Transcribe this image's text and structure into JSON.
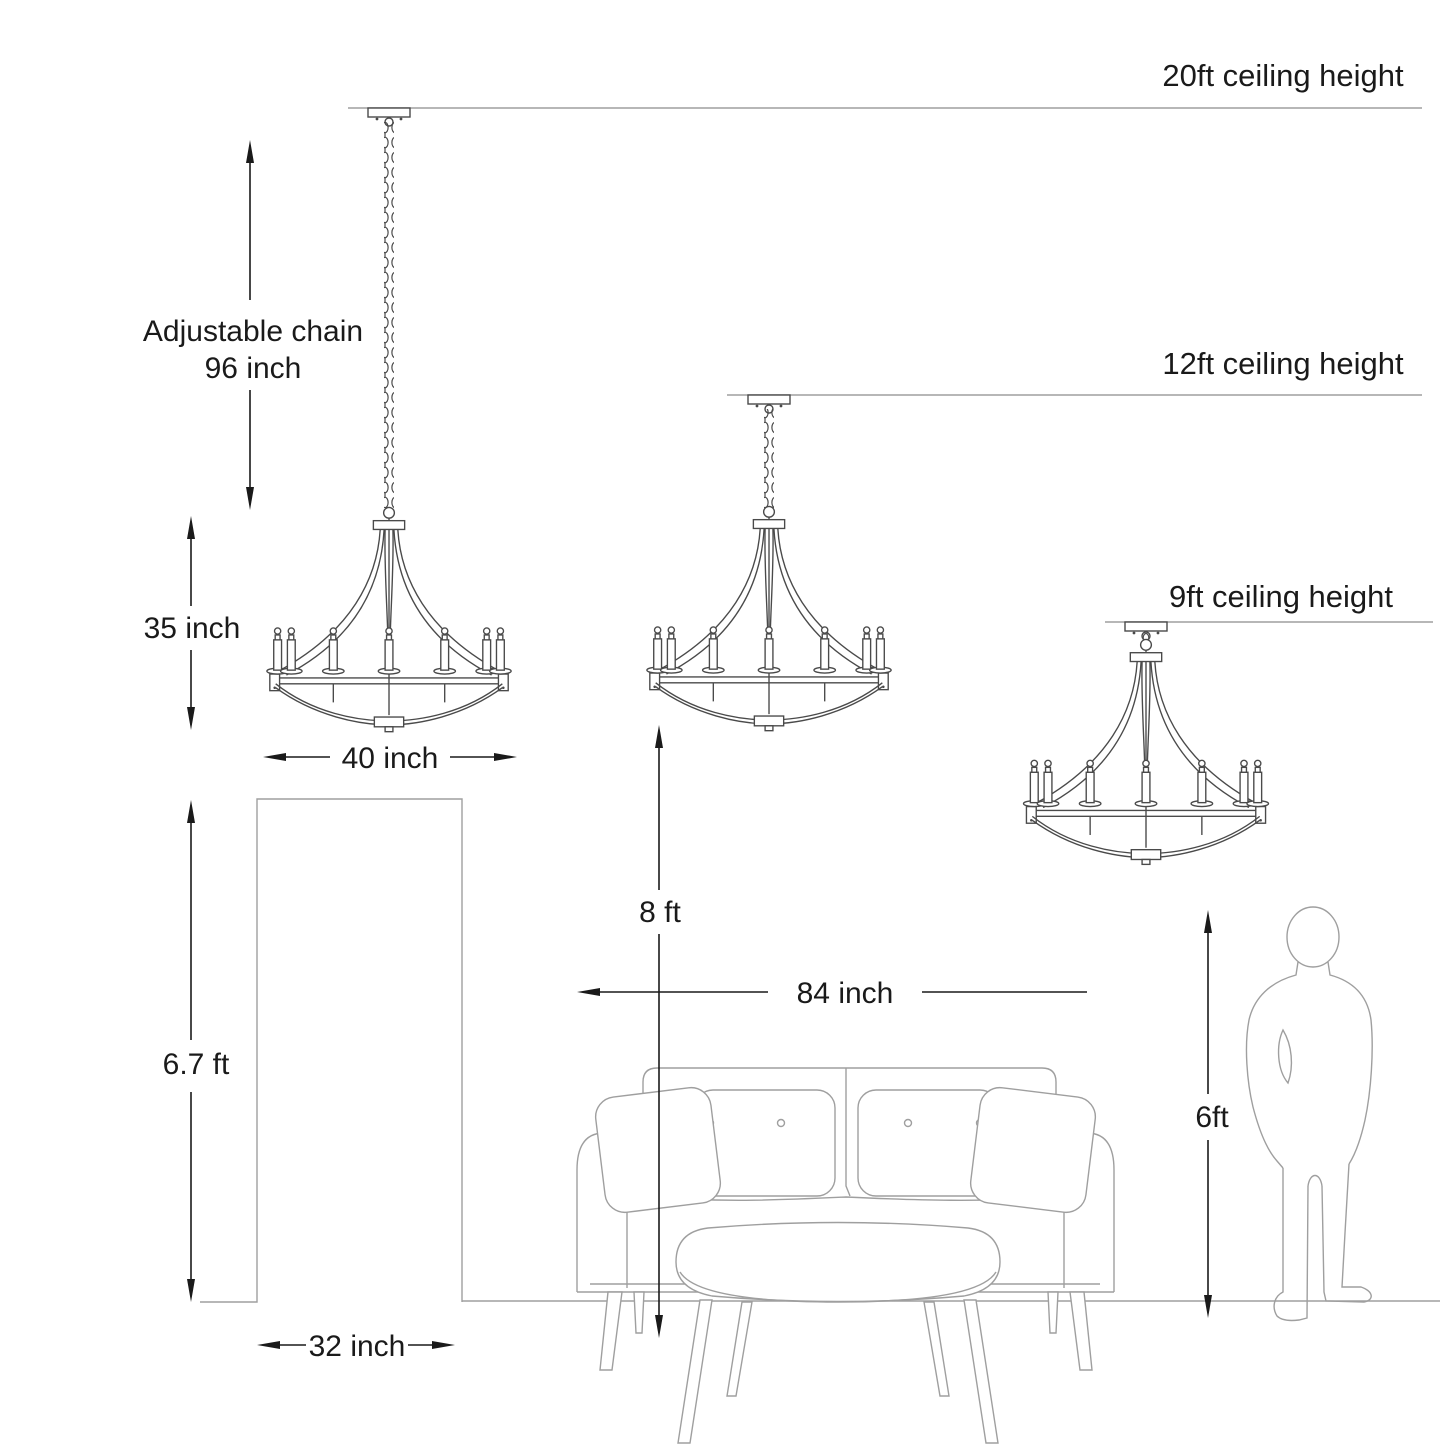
{
  "diagram": {
    "kind": "chandelier-installation-size-guide",
    "background": "#ffffff",
    "colors": {
      "furniture_line": "#9f9f9f",
      "fixture_line": "#4a4a4a",
      "dimension_line": "#1a1a1a",
      "text": "#1a1a1a"
    }
  },
  "labels": {
    "ceiling_20ft": "20ft ceiling height",
    "ceiling_12ft": "12ft ceiling height",
    "ceiling_9ft": "9ft ceiling height",
    "adjustable_chain_line1": "Adjustable chain",
    "adjustable_chain_line2": "96 inch",
    "fixture_height": "35 inch",
    "fixture_width": "40 inch",
    "door_height": "6.7 ft",
    "door_width": "32 inch",
    "floor_to_fixture": "8 ft",
    "sofa_width": "84 inch",
    "person_height": "6ft"
  }
}
